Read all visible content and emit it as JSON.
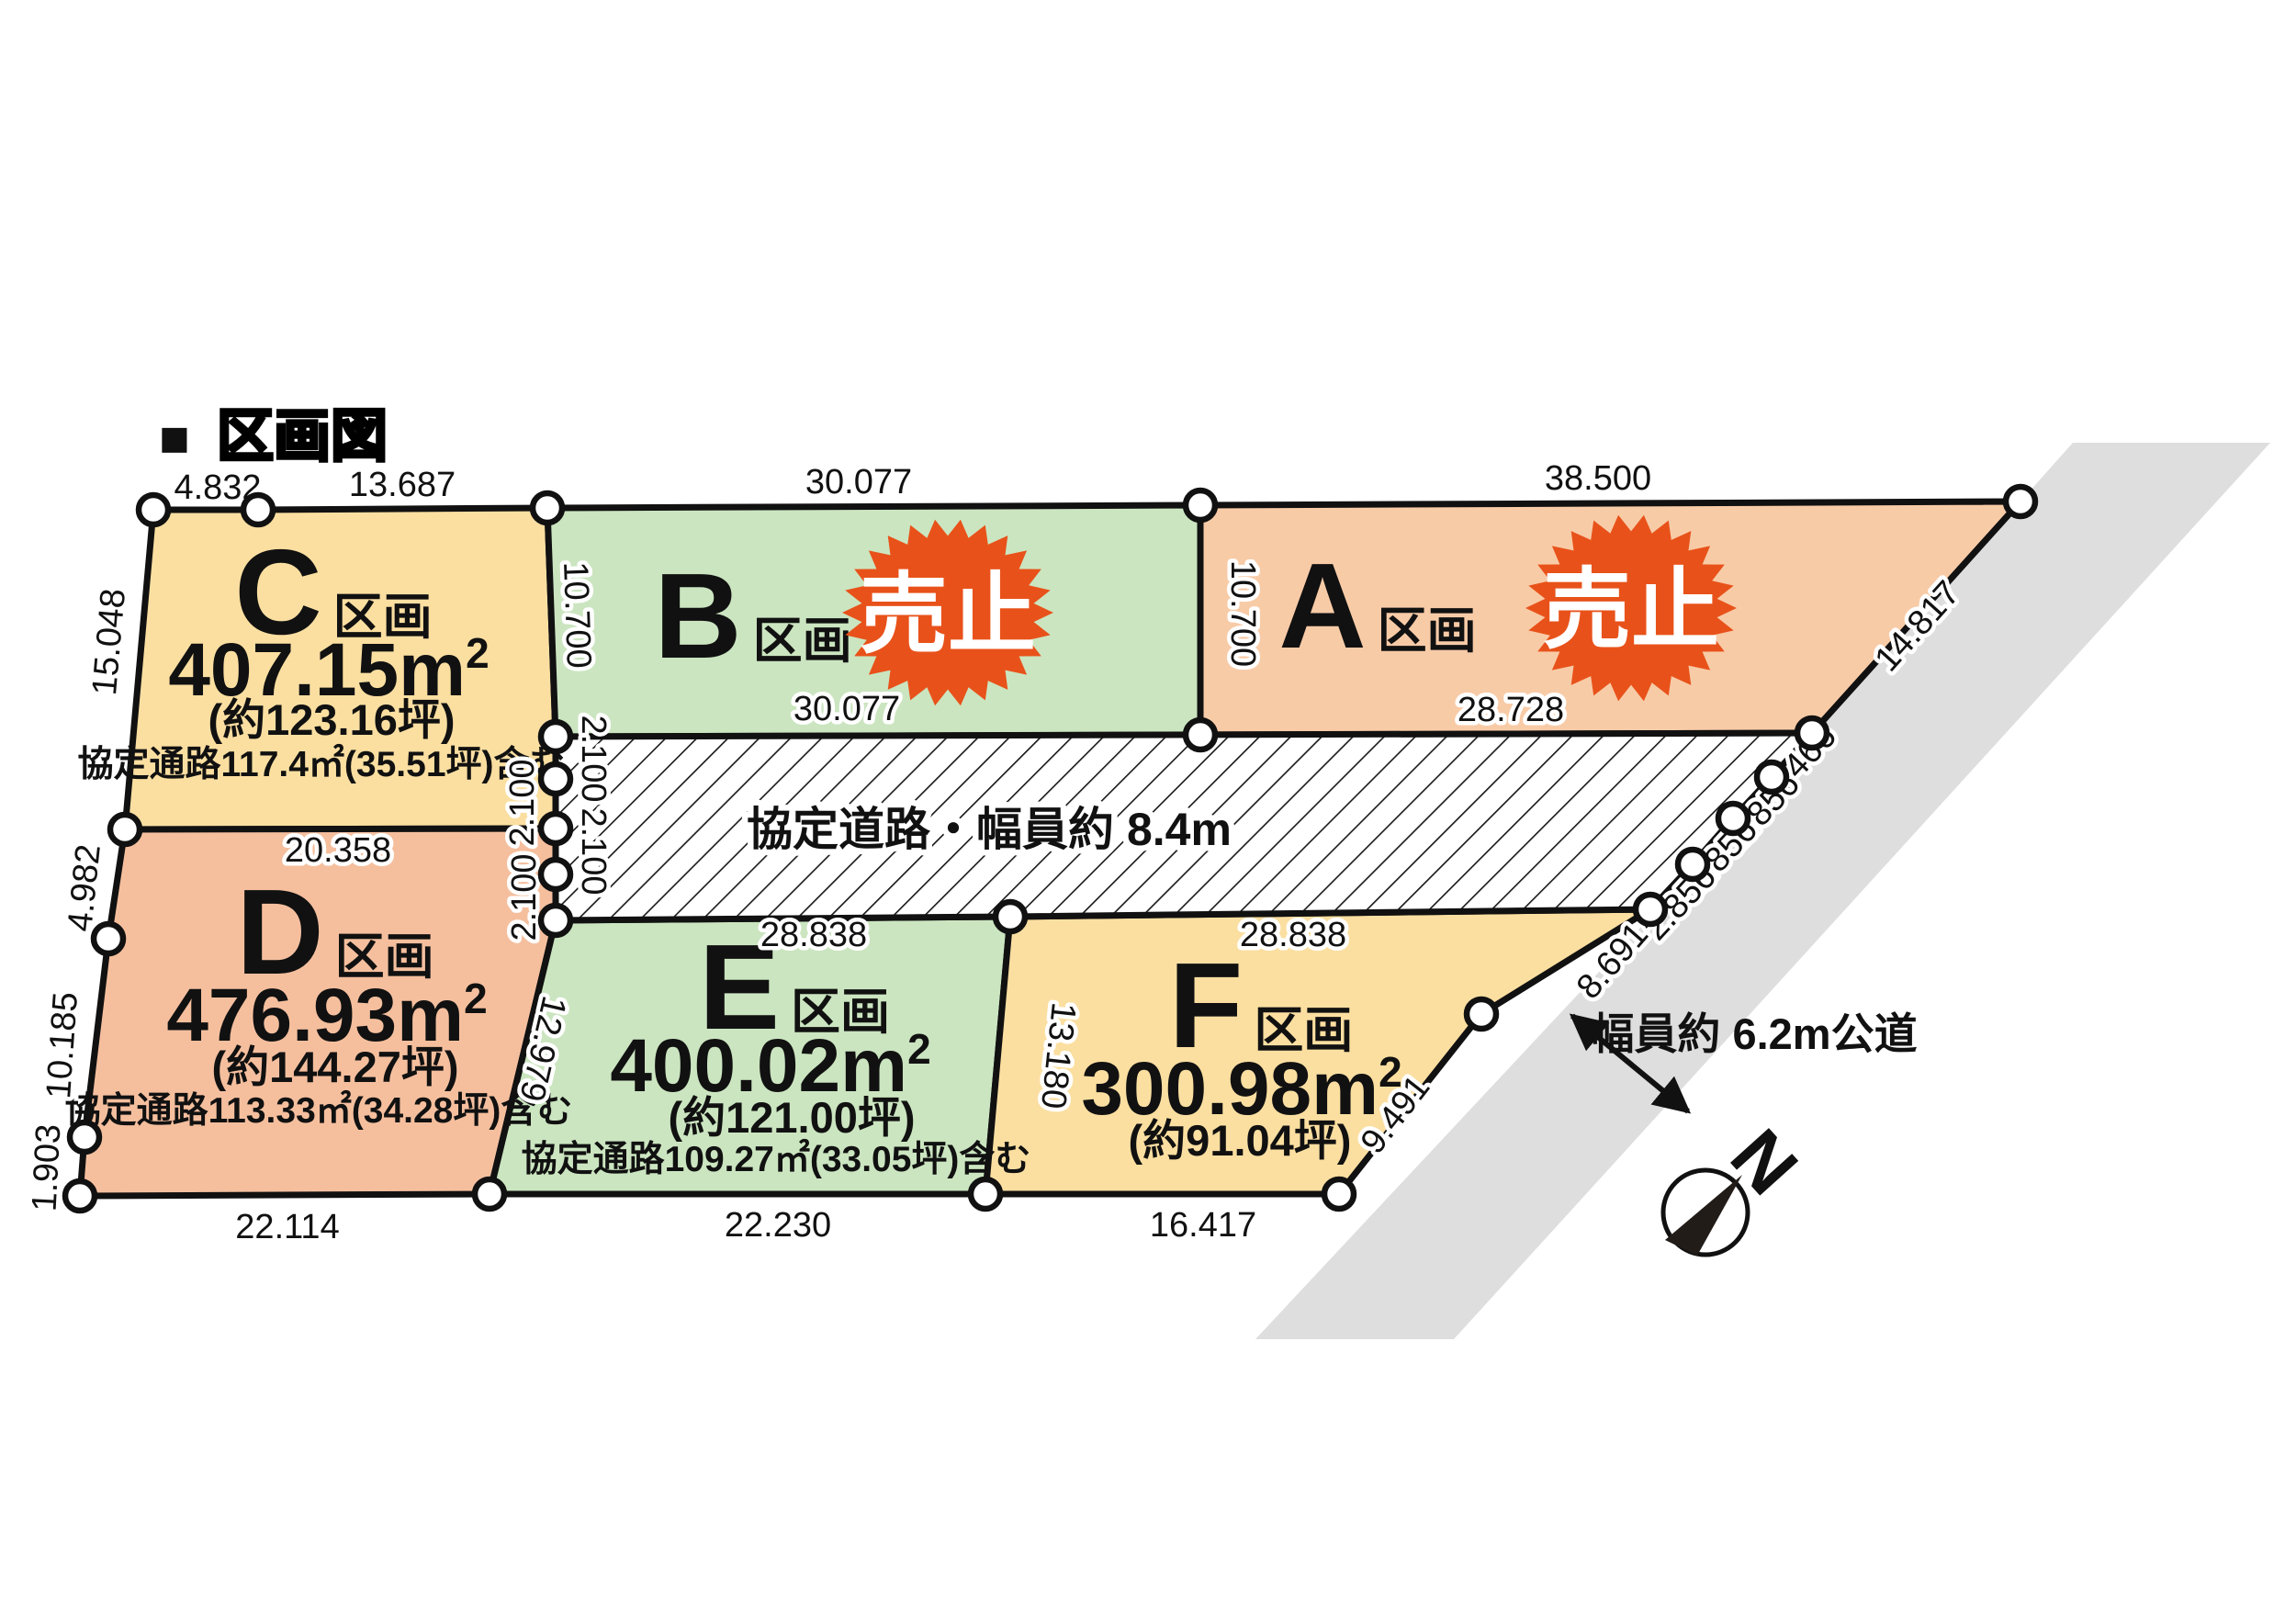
{
  "title": {
    "bullet": "■",
    "text": "区画図"
  },
  "units": {
    "m": "m",
    "sup": "2"
  },
  "plots": {
    "A": {
      "label": "A",
      "suffix": "区画",
      "badge": "売止"
    },
    "B": {
      "label": "B",
      "suffix": "区画",
      "badge": "売止"
    },
    "C": {
      "label": "C",
      "suffix": "区画",
      "size": "407.15",
      "tsubo": "(約123.16坪)",
      "note": "協定通路117.4㎡(35.51坪)含む"
    },
    "D": {
      "label": "D",
      "suffix": "区画",
      "size": "476.93",
      "tsubo": "(約144.27坪)",
      "note": "協定通路113.33㎡(34.28坪)含む"
    },
    "E": {
      "label": "E",
      "suffix": "区画",
      "size": "400.02",
      "tsubo": "(約121.00坪)",
      "note": "協定通路109.27㎡(33.05坪)含む"
    },
    "F": {
      "label": "F",
      "suffix": "区画",
      "size": "300.98",
      "tsubo": "(約91.04坪)"
    }
  },
  "roads": {
    "agreement": "協定道路・幅員約 8.4m",
    "public": "幅員約 6.2m公道"
  },
  "compass": {
    "north": "N"
  },
  "colors": {
    "plot_yellow": "#FBDFA1",
    "plot_green": "#CBE5C0",
    "plot_salmon_a": "#F8CBA7",
    "plot_salmon_d": "#F5BF9E",
    "badge_orange": "#E8521A",
    "road_gray": "#DEDEDF"
  },
  "dims": [
    {
      "t": "4.832"
    },
    {
      "t": "13.687"
    },
    {
      "t": "30.077"
    },
    {
      "t": "38.500"
    },
    {
      "t": "15.048"
    },
    {
      "t": "10.700"
    },
    {
      "t": "10.700"
    },
    {
      "t": "14.817"
    },
    {
      "t": "30.077"
    },
    {
      "t": "28.728"
    },
    {
      "t": "2.466"
    },
    {
      "t": "2.856"
    },
    {
      "t": "2.856"
    },
    {
      "t": "2.856"
    },
    {
      "t": "2.100"
    },
    {
      "t": "2.100"
    },
    {
      "t": "2.100"
    },
    {
      "t": "2.100"
    },
    {
      "t": "20.358"
    },
    {
      "t": "4.982"
    },
    {
      "t": "10.185"
    },
    {
      "t": "1.903"
    },
    {
      "t": "12.979"
    },
    {
      "t": "13.180"
    },
    {
      "t": "28.838"
    },
    {
      "t": "28.838"
    },
    {
      "t": "8.691"
    },
    {
      "t": "9.491"
    },
    {
      "t": "22.114"
    },
    {
      "t": "22.230"
    },
    {
      "t": "16.417"
    }
  ]
}
